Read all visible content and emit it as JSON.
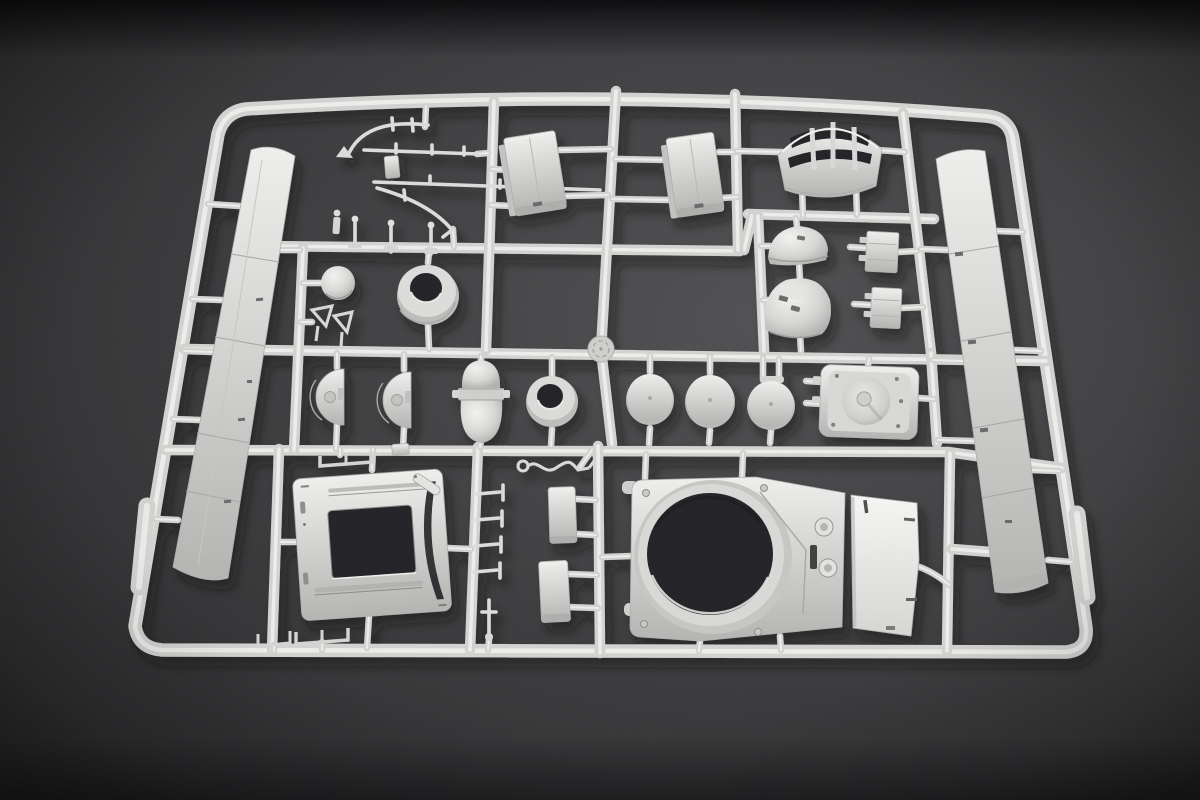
{
  "scene": {
    "type": "photograph",
    "subject": "model-kit-sprue",
    "description": "Light grey injection-moulded plastic model kit sprue (parts tree) with armoured-vehicle parts, photographed at a slight tilt on a dark grey studio background",
    "background_surface": "dark grey matte surface",
    "plastic_color_name": "light grey"
  },
  "sprue": {
    "frame_shape": "rounded-rectangle",
    "parts": [
      "frame-rails",
      "hull-panel-left",
      "hull-panel-right",
      "cable-bracket-set",
      "stowage-box-left",
      "stowage-box-right",
      "grille-cover",
      "vision-dome-small",
      "vision-dome-large",
      "fitting-block-upper",
      "fitting-block-lower",
      "ball-mount",
      "ring-collar",
      "flag-brackets",
      "gate-marker-disc",
      "half-disc-left",
      "half-disc-right",
      "capsule-hatch",
      "small-ring",
      "wheel-disc-1",
      "wheel-disc-2",
      "wheel-disc-3",
      "ventilator-plate",
      "grab-wire",
      "bracket-staples",
      "turret-base-frame",
      "fastener-pins",
      "utility-box-upper",
      "utility-box-lower",
      "turret-roof-plate",
      "mantlet-plate"
    ]
  },
  "colors": {
    "background_light": "#505052",
    "background_mid": "#3c3c3e",
    "background_dark": "#29292b",
    "background_top": "#19191b",
    "plastic_light": "#efefed",
    "plastic_mid": "#d2d2d0",
    "plastic_dark": "#b4b4b2",
    "plastic_deep": "#939391",
    "hole": "#232325",
    "shadow": "#0e0e10"
  }
}
